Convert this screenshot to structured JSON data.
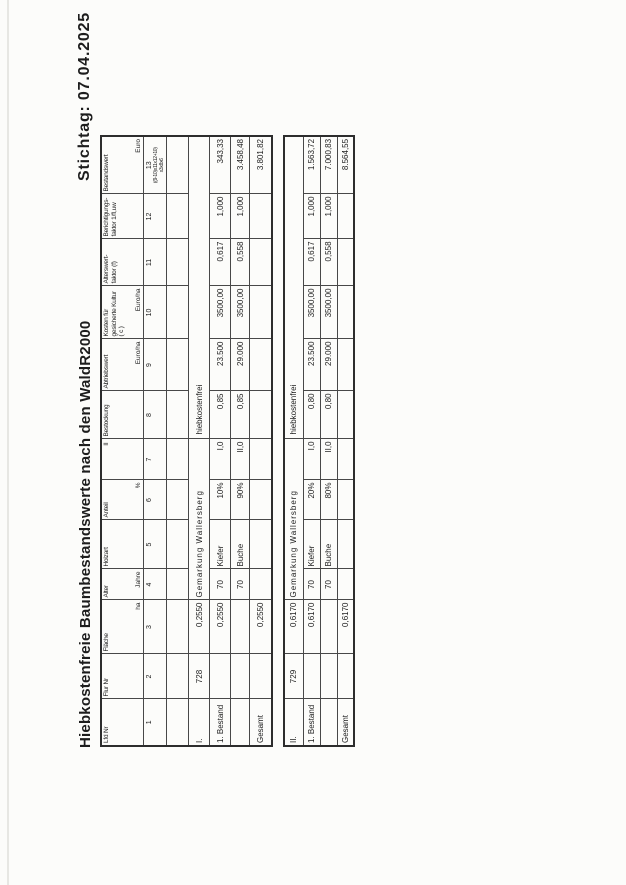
{
  "page": {
    "title": "Hiebkostenfreie Baumbestandswerte nach den WaldR2000",
    "stichtag": "Stichtag: 07.04.2025"
  },
  "table": {
    "headers": [
      {
        "num": "1",
        "label": "Lfd Nr",
        "unit": ""
      },
      {
        "num": "2",
        "label": "Flur Nr",
        "unit": ""
      },
      {
        "num": "3",
        "label": "Fläche",
        "unit": "ha"
      },
      {
        "num": "4",
        "label": "Alter",
        "unit": "Jahre"
      },
      {
        "num": "5",
        "label": "Holzart",
        "unit": ""
      },
      {
        "num": "6",
        "label": "Anteil",
        "unit": "%"
      },
      {
        "num": "7",
        "label": "II",
        "unit": ""
      },
      {
        "num": "8",
        "label": "Bestockung",
        "unit": ""
      },
      {
        "num": "9",
        "label": "Abtriebswert",
        "unit": "Euro/ha"
      },
      {
        "num": "10",
        "label": "Kosten für gesicherte Kultur ( c )",
        "unit": "Euro/ha"
      },
      {
        "num": "11",
        "label": "Alterswert- faktor (f)",
        "unit": ""
      },
      {
        "num": "12",
        "label": "Berichtigungs- faktor 1/fl,uw",
        "unit": ""
      },
      {
        "num": "13",
        "label": "Bestandswert",
        "unit": "Euro",
        "formula_1": "((9-10)x11x12+10)",
        "formula_2": "x3x8x6"
      }
    ]
  },
  "sections": [
    {
      "id": "I.",
      "flur_nr": "728",
      "flaeche": "0,2550",
      "gemarkung": "Gemarkung Wallersberg",
      "note": "hiebkostenfrei",
      "rows": [
        {
          "label": "1. Bestand",
          "flaeche": "0,2550",
          "alter": "70",
          "holzart": "Kiefer",
          "anteil": "10%",
          "ertragsklasse": "I,0",
          "bestockung": "0,85",
          "abtriebswert": "23.500",
          "kosten": "3500,00",
          "alterswertfaktor": "0,617",
          "berichtigungsfaktor": "1,000",
          "bestandswert": "343,33"
        },
        {
          "label": "",
          "flaeche": "",
          "alter": "70",
          "holzart": "Buche",
          "anteil": "90%",
          "ertragsklasse": "II,0",
          "bestockung": "0,85",
          "abtriebswert": "29.000",
          "kosten": "3500,00",
          "alterswertfaktor": "0,558",
          "berichtigungsfaktor": "1,000",
          "bestandswert": "3.458,48"
        }
      ],
      "gesamt": {
        "label": "Gesamt",
        "flaeche": "0,2550",
        "bestandswert": "3.801,82"
      }
    },
    {
      "id": "II.",
      "flur_nr": "729",
      "flaeche": "0,6170",
      "gemarkung": "Gemarkung Wallersberg",
      "note": "hiebkostenfrei",
      "rows": [
        {
          "label": "1. Bestand",
          "flaeche": "0,6170",
          "alter": "70",
          "holzart": "Kiefer",
          "anteil": "20%",
          "ertragsklasse": "I,0",
          "bestockung": "0,80",
          "abtriebswert": "23.500",
          "kosten": "3500,00",
          "alterswertfaktor": "0,617",
          "berichtigungsfaktor": "1,000",
          "bestandswert": "1.563,72"
        },
        {
          "label": "",
          "flaeche": "",
          "alter": "70",
          "holzart": "Buche",
          "anteil": "80%",
          "ertragsklasse": "II,0",
          "bestockung": "0,80",
          "abtriebswert": "29.000",
          "kosten": "3500,00",
          "alterswertfaktor": "0,558",
          "berichtigungsfaktor": "1,000",
          "bestandswert": "7.000,83"
        }
      ],
      "gesamt": {
        "label": "Gesamt",
        "flaeche": "0,6170",
        "bestandswert": "8.564,55"
      }
    }
  ]
}
